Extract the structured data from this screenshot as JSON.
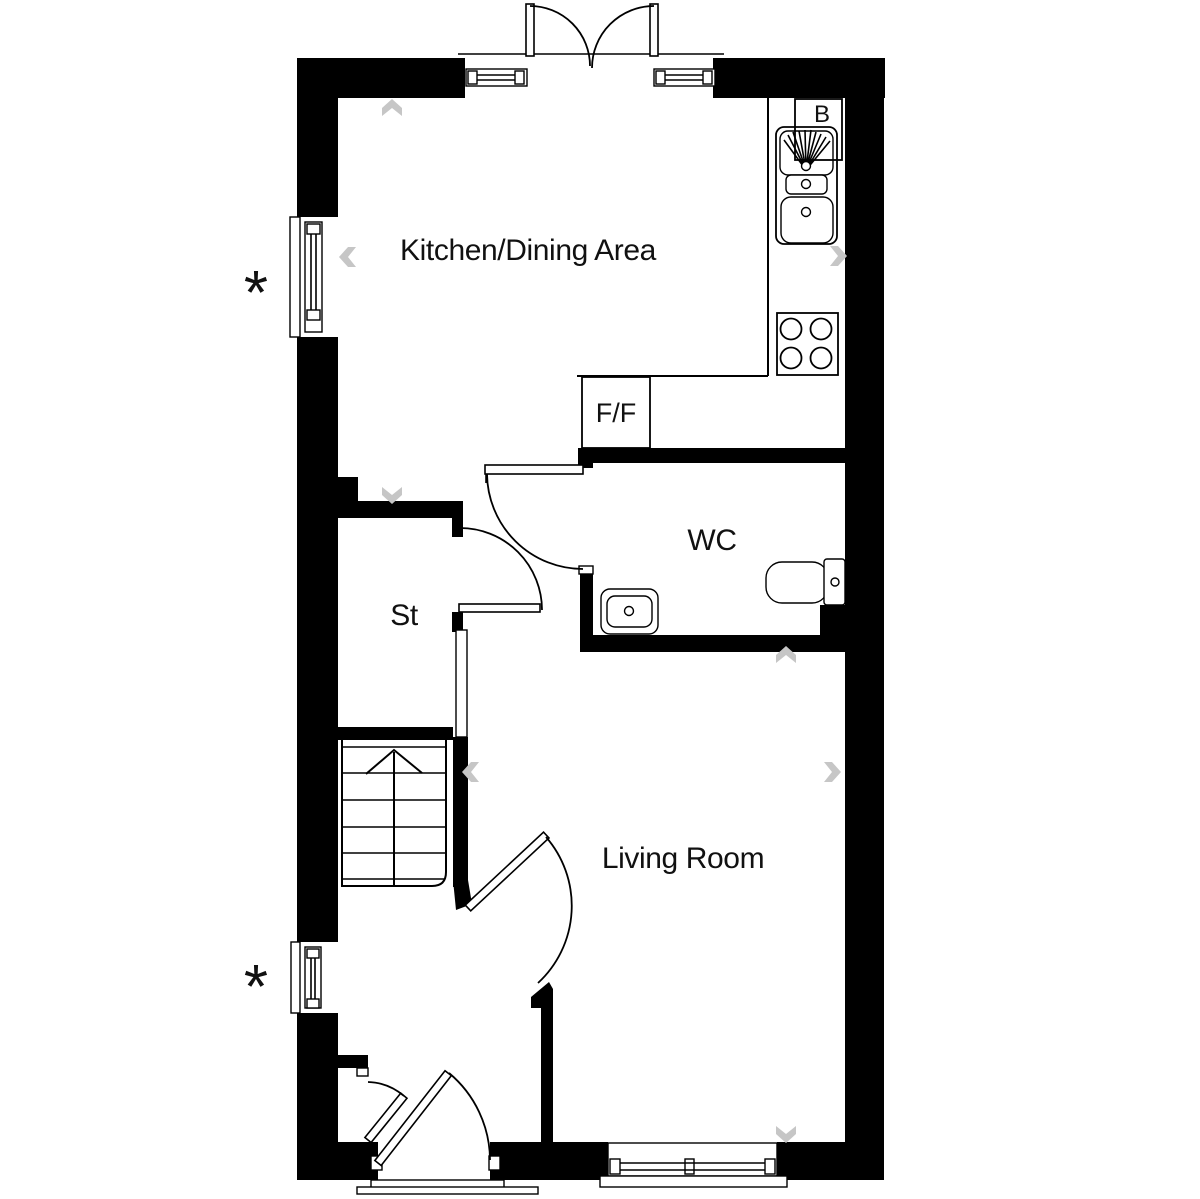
{
  "plan": {
    "rooms": {
      "kitchen_dining": {
        "label": "Kitchen/Dining Area"
      },
      "wc": {
        "label": "WC"
      },
      "store": {
        "label": "St"
      },
      "living_room": {
        "label": "Living Room"
      }
    },
    "appliances": {
      "fridge_freezer": {
        "label": "F/F"
      },
      "boiler": {
        "label": "B"
      }
    },
    "markers": {
      "window_note_upper": "*",
      "window_note_lower": "*"
    },
    "colors": {
      "wall": "#000000",
      "line": "#000000",
      "chevron": "#c6c6c6",
      "text": "#111111",
      "background": "#ffffff"
    }
  }
}
